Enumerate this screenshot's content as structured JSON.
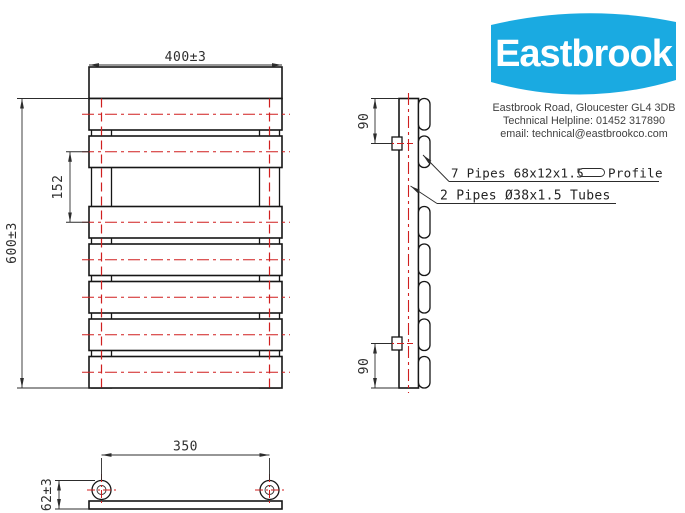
{
  "company": {
    "brand": "Eastbrook",
    "address": "Eastbrook Road, Gloucester GL4 3DB",
    "helpline": "Technical Helpline: 01452 317890",
    "email": "email: technical@eastbrookco.com"
  },
  "dimensions": {
    "overall_width": "400±3",
    "overall_height": "600±3",
    "towel_gap": "152",
    "top_connection_offset": "90",
    "bottom_connection_offset": "90",
    "pipe_centres": "350",
    "depth": "62±3"
  },
  "annotations": {
    "profile_label": "7 Pipes 68x12x1.5",
    "profile_suffix": "Profile",
    "tubes_label": "2 Pipes Ø38x1.5 Tubes"
  },
  "colors": {
    "brand_blue": "#1aaae1",
    "centerline_red": "#d01f1f",
    "line_black": "#161616"
  }
}
